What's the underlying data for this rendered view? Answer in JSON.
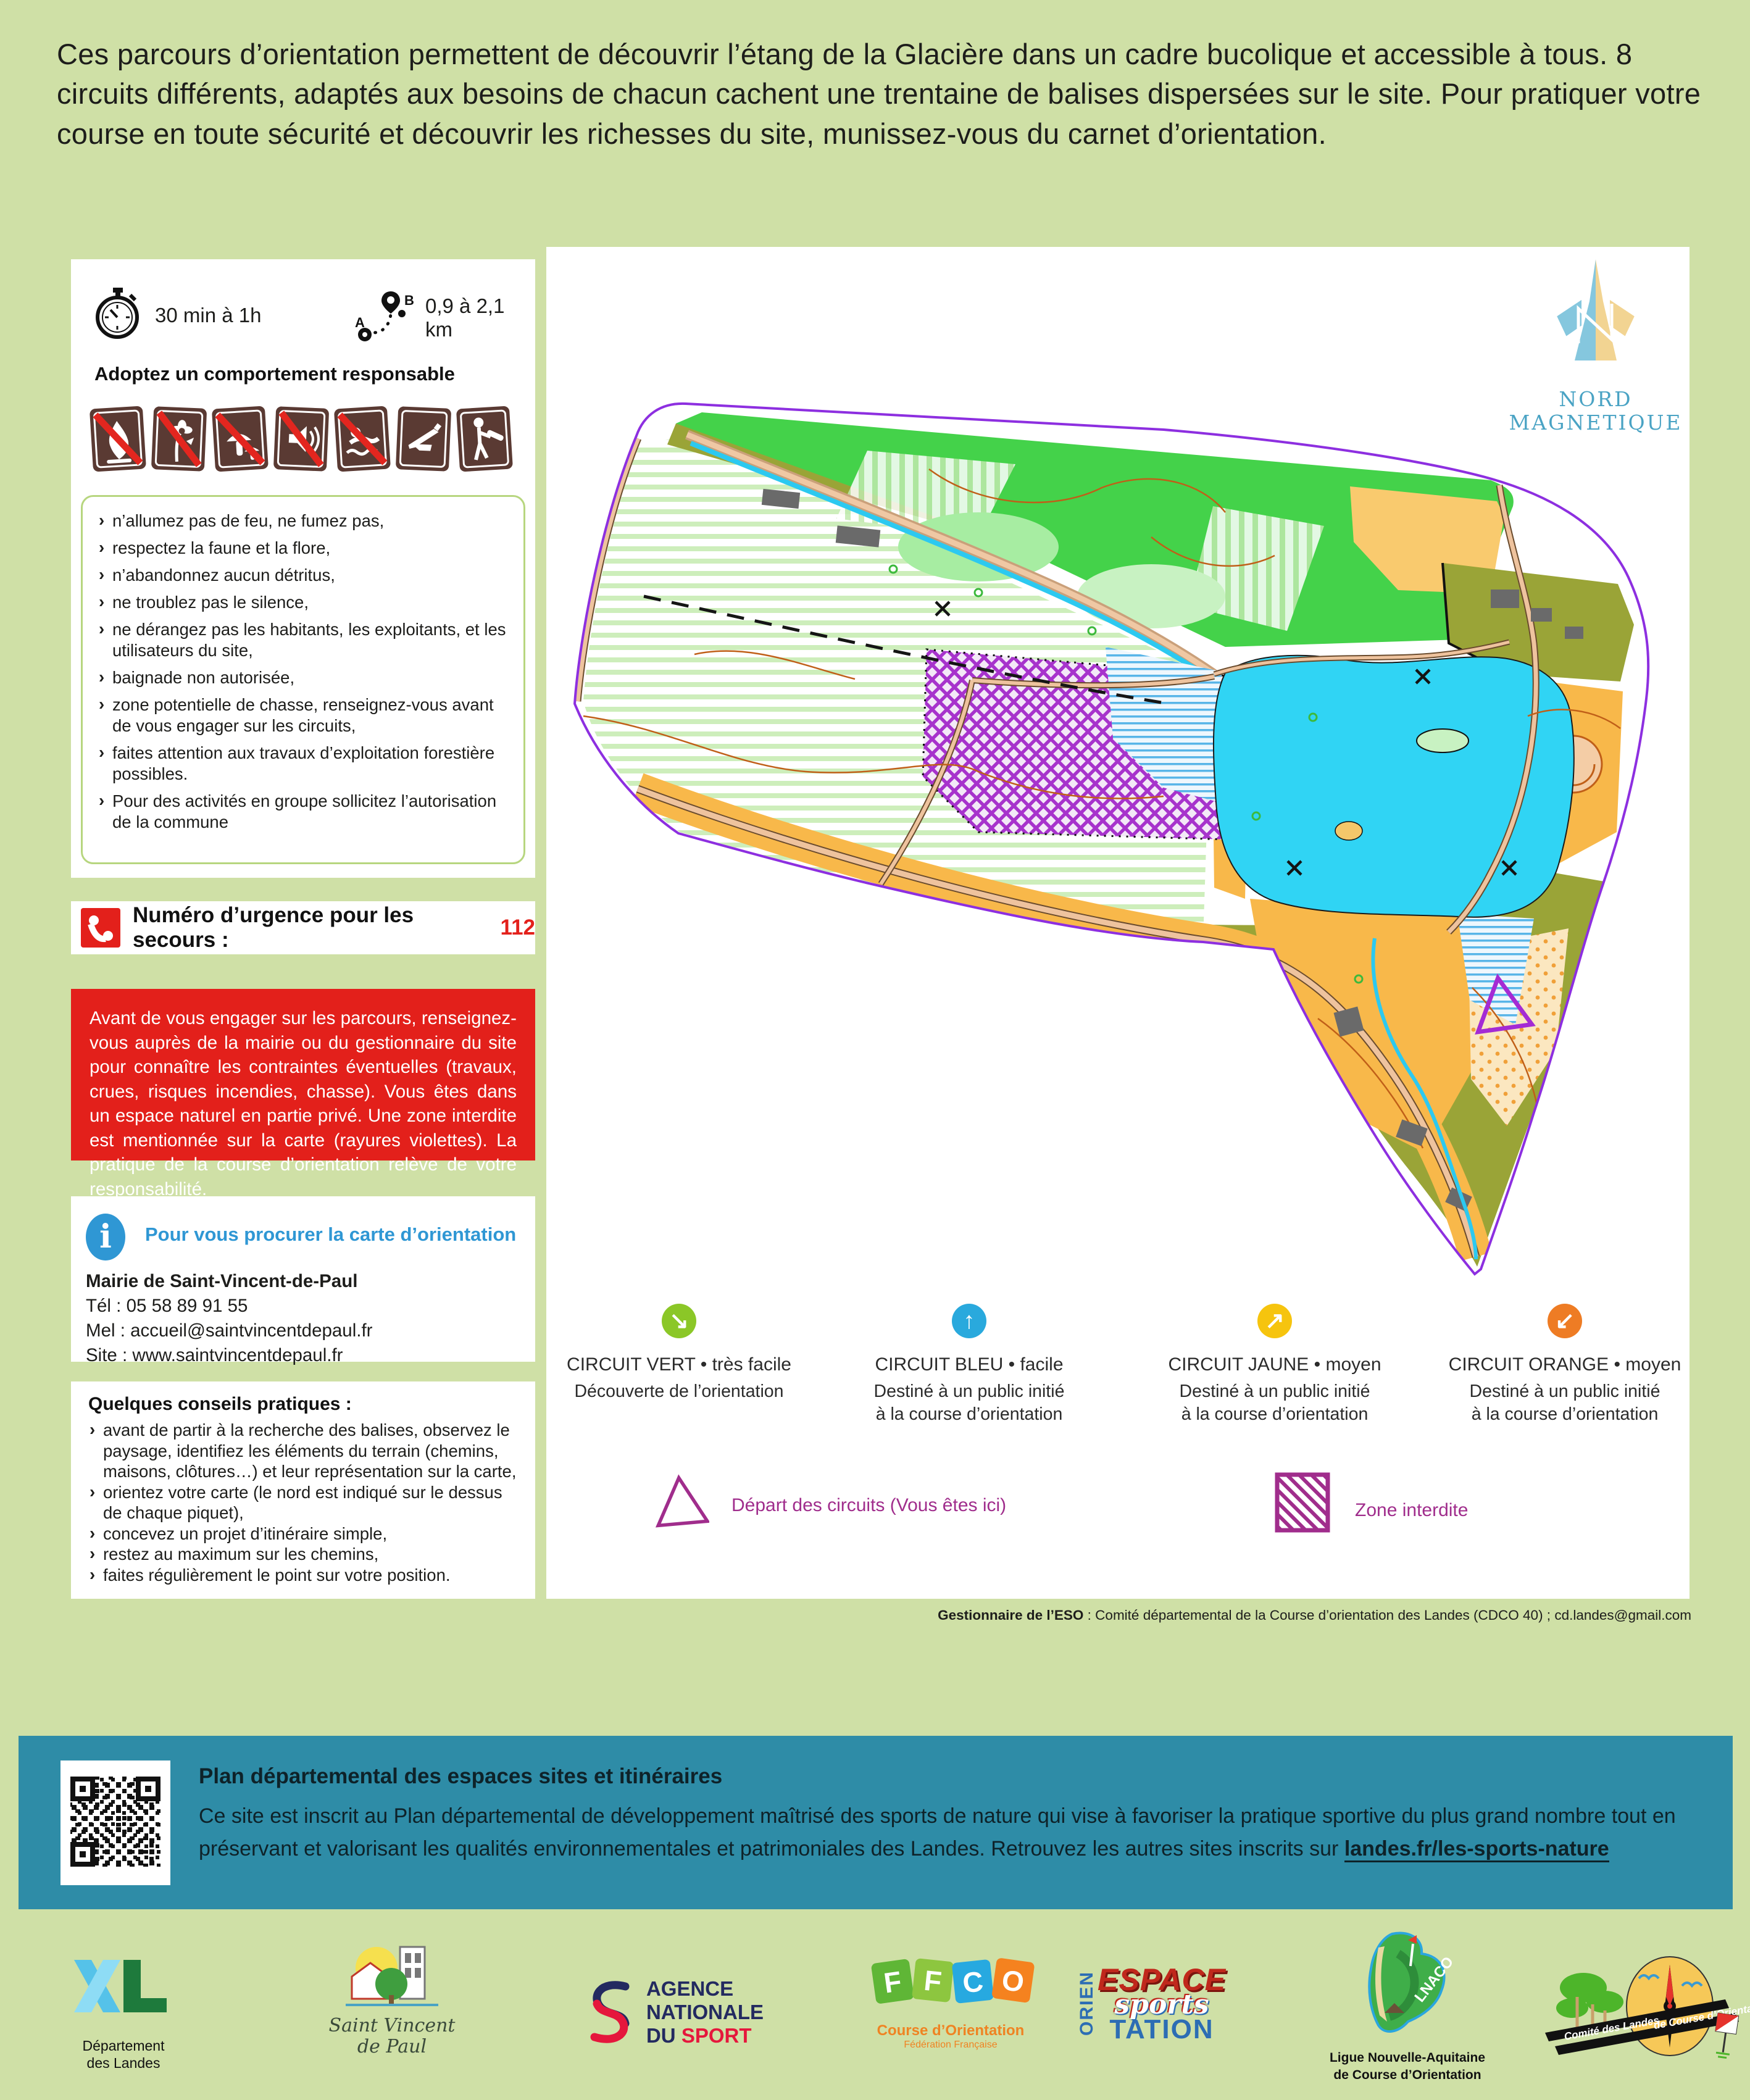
{
  "intro": "Ces parcours d’orientation permettent de découvrir l’étang de la Glacière dans un cadre bucolique et accessible à tous. 8 circuits différents, adaptés aux besoins de chacun cachent une trentaine de balises dispersées sur le site. Pour pratiquer votre course en toute sécurité et découvrir les richesses du site, munissez-vous du carnet d’orientation.",
  "stats": {
    "duration": "30 min à 1h",
    "distance": "0,9 à 2,1 km"
  },
  "behavior": {
    "title": "Adoptez un comportement responsable",
    "pictos": [
      "no-fire",
      "no-flower-picking",
      "no-mushroom-picking",
      "no-noise",
      "no-swimming",
      "hunting-possible",
      "forestry-works"
    ],
    "rules": [
      "n’allumez pas de feu, ne fumez pas,",
      "respectez la faune et la flore,",
      "n’abandonnez aucun détritus,",
      "ne troublez pas le silence,",
      "ne dérangez pas les habitants, les exploitants, et les utilisateurs du site,",
      "baignade non autorisée,",
      "zone potentielle de chasse, renseignez-vous avant de vous engager sur les circuits,",
      "faites attention aux travaux d’exploitation forestière possibles.",
      "Pour des activités en groupe sollicitez l’autorisation de la commune"
    ]
  },
  "emergency": {
    "label": "Numéro d’urgence pour les secours :",
    "number": "112"
  },
  "warning": "Avant de vous engager sur les parcours, renseignez-vous auprès de la mairie ou du gestionnaire du site pour connaître les contraintes éventuelles (travaux, crues, risques incendies, chasse). Vous êtes dans un espace naturel en partie privé. Une zone interdite est mentionnée sur la carte (rayures violettes). La pratique de la course d’orientation relève de votre responsabilité.",
  "info": {
    "title": "Pour vous procurer la carte d’orientation",
    "org": "Mairie de Saint-Vincent-de-Paul",
    "tel": "Tél : 05 58 89 91 55",
    "mail": "Mel : accueil@saintvincentdepaul.fr",
    "site": "Site : www.saintvincentdepaul.fr"
  },
  "tips": {
    "title": "Quelques conseils pratiques :",
    "items": [
      "avant de partir à la recherche des balises, observez le paysage, identifiez les éléments du terrain (chemins, maisons, clôtures…) et leur représentation sur la carte,",
      "orientez votre carte (le nord est indiqué sur le dessus de chaque piquet),",
      "concevez un projet d’itinéraire simple,",
      "restez au maximum sur les chemins,",
      "faites régulièrement le point sur votre position."
    ]
  },
  "map": {
    "north1": "NORD",
    "north2": "MAGNETIQUE",
    "route_a": "A",
    "route_b": "B"
  },
  "circuits": [
    {
      "title": "CIRCUIT VERT • très facile",
      "desc1": "Découverte de l’orientation",
      "desc2": "",
      "arrow": "↘",
      "color": "#8bc727"
    },
    {
      "title": "CIRCUIT BLEU • facile",
      "desc1": "Destiné à un public initié",
      "desc2": "à la course d’orientation",
      "arrow": "↑",
      "color": "#29a9dd"
    },
    {
      "title": "CIRCUIT JAUNE • moyen",
      "desc1": "Destiné à un public initié",
      "desc2": "à la course d’orientation",
      "arrow": "↗",
      "color": "#f6c40e"
    },
    {
      "title": "CIRCUIT ORANGE • moyen",
      "desc1": "Destiné à un public initié",
      "desc2": "à la course d’orientation",
      "arrow": "↙",
      "color": "#ee7c24"
    }
  ],
  "legend": {
    "start": "Départ des circuits (Vous êtes ici)",
    "forbidden": "Zone interdite"
  },
  "manager": {
    "label": "Gestionnaire de l’ESO",
    "text": " : Comité départemental de la Course d’orientation des Landes (CDCO 40) ; cd.landes@gmail.com"
  },
  "banner": {
    "title": "Plan départemental des espaces sites et itinéraires",
    "body": "Ce site est inscrit au Plan départemental de développement maîtrisé des sports de nature qui vise à favoriser la pratique sportive du plus grand nombre tout en préservant et valorisant les qualités environnementales et patrimoniales des Landes. Retrouvez les autres sites inscrits sur ",
    "link": "landes.fr/les-sports-nature"
  },
  "logos": {
    "landes": {
      "l1": "Département",
      "l2": "des Landes"
    },
    "svp": {
      "l1": "Saint Vincent",
      "l2": "de Paul"
    },
    "ans": {
      "l1": "AGENCE",
      "l2": "NATIONALE",
      "l3": "DU ",
      "l4": "SPORT"
    },
    "ffco": {
      "f1": "F",
      "f2": "F",
      "c": "C",
      "o": "O",
      "cap1": "Course d’Orientation",
      "cap2": "Fédération Française"
    },
    "eso": {
      "w1": "ESPACE",
      "w2": "sports",
      "w3": "ORIEN",
      "w4": "TATION"
    },
    "lnaco": {
      "badge": "LNACO",
      "cap1": "Ligue Nouvelle-Aquitaine",
      "cap2": "de Course d’Orientation"
    },
    "cdco": {
      "cap1": "Comité des Landes",
      "cap2": "de Course d’Orientation"
    }
  },
  "colors": {
    "page_bg": "#cfe0a6",
    "banner": "#2e8ca7",
    "alert_red": "#e3201b",
    "info_blue": "#2f97d4",
    "legend_purple": "#a02d8c",
    "map_border_violet": "#8d2fe0",
    "lake_cyan": "#30d4f4",
    "forest_green": "#44d24a",
    "olive": "#9aa437",
    "open_orange": "#f8b84a",
    "forbidden_purple": "#a733cc"
  }
}
